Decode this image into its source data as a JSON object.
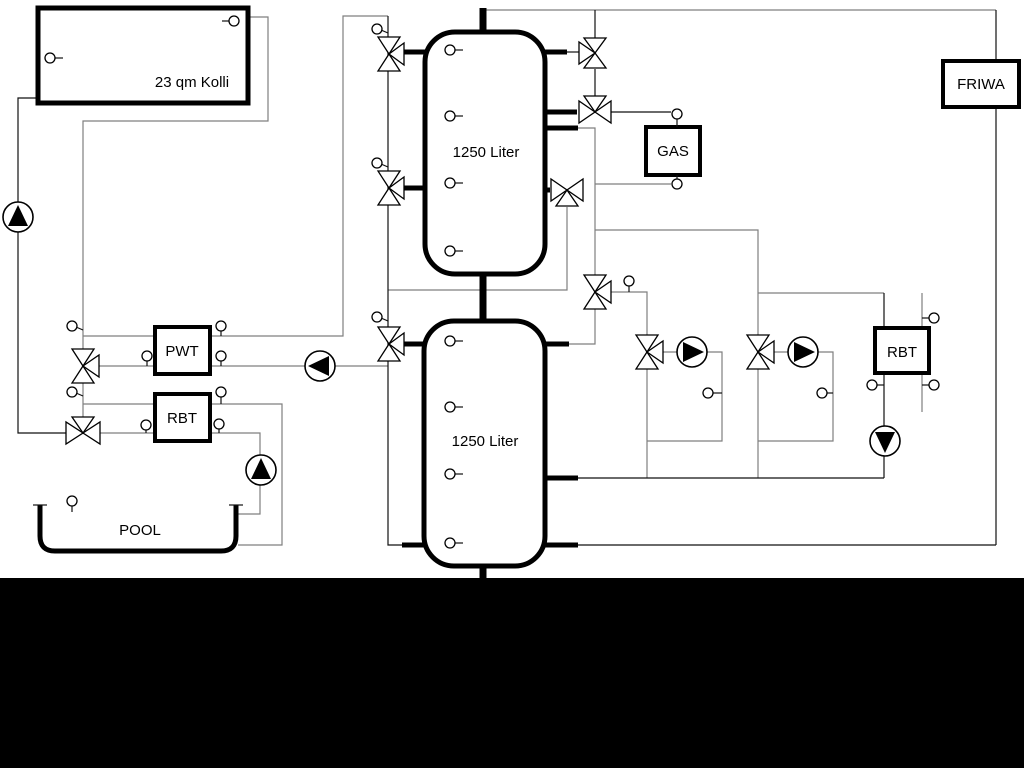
{
  "diagram": {
    "collector": {
      "label": "23 qm Kolli"
    },
    "tank_top": {
      "label": "1250 Liter"
    },
    "tank_bottom": {
      "label": "1250 Liter"
    },
    "gas": {
      "label": "GAS"
    },
    "friwa": {
      "label": "FRIWA"
    },
    "pwt": {
      "label": "PWT"
    },
    "rbt_left": {
      "label": "RBT"
    },
    "rbt_right": {
      "label": "RBT"
    },
    "pool": {
      "label": "POOL"
    },
    "colors": {
      "background": "#ffffff",
      "footer": "#000000",
      "line_gray": "#7f7f7f",
      "line_black": "#111111"
    }
  }
}
